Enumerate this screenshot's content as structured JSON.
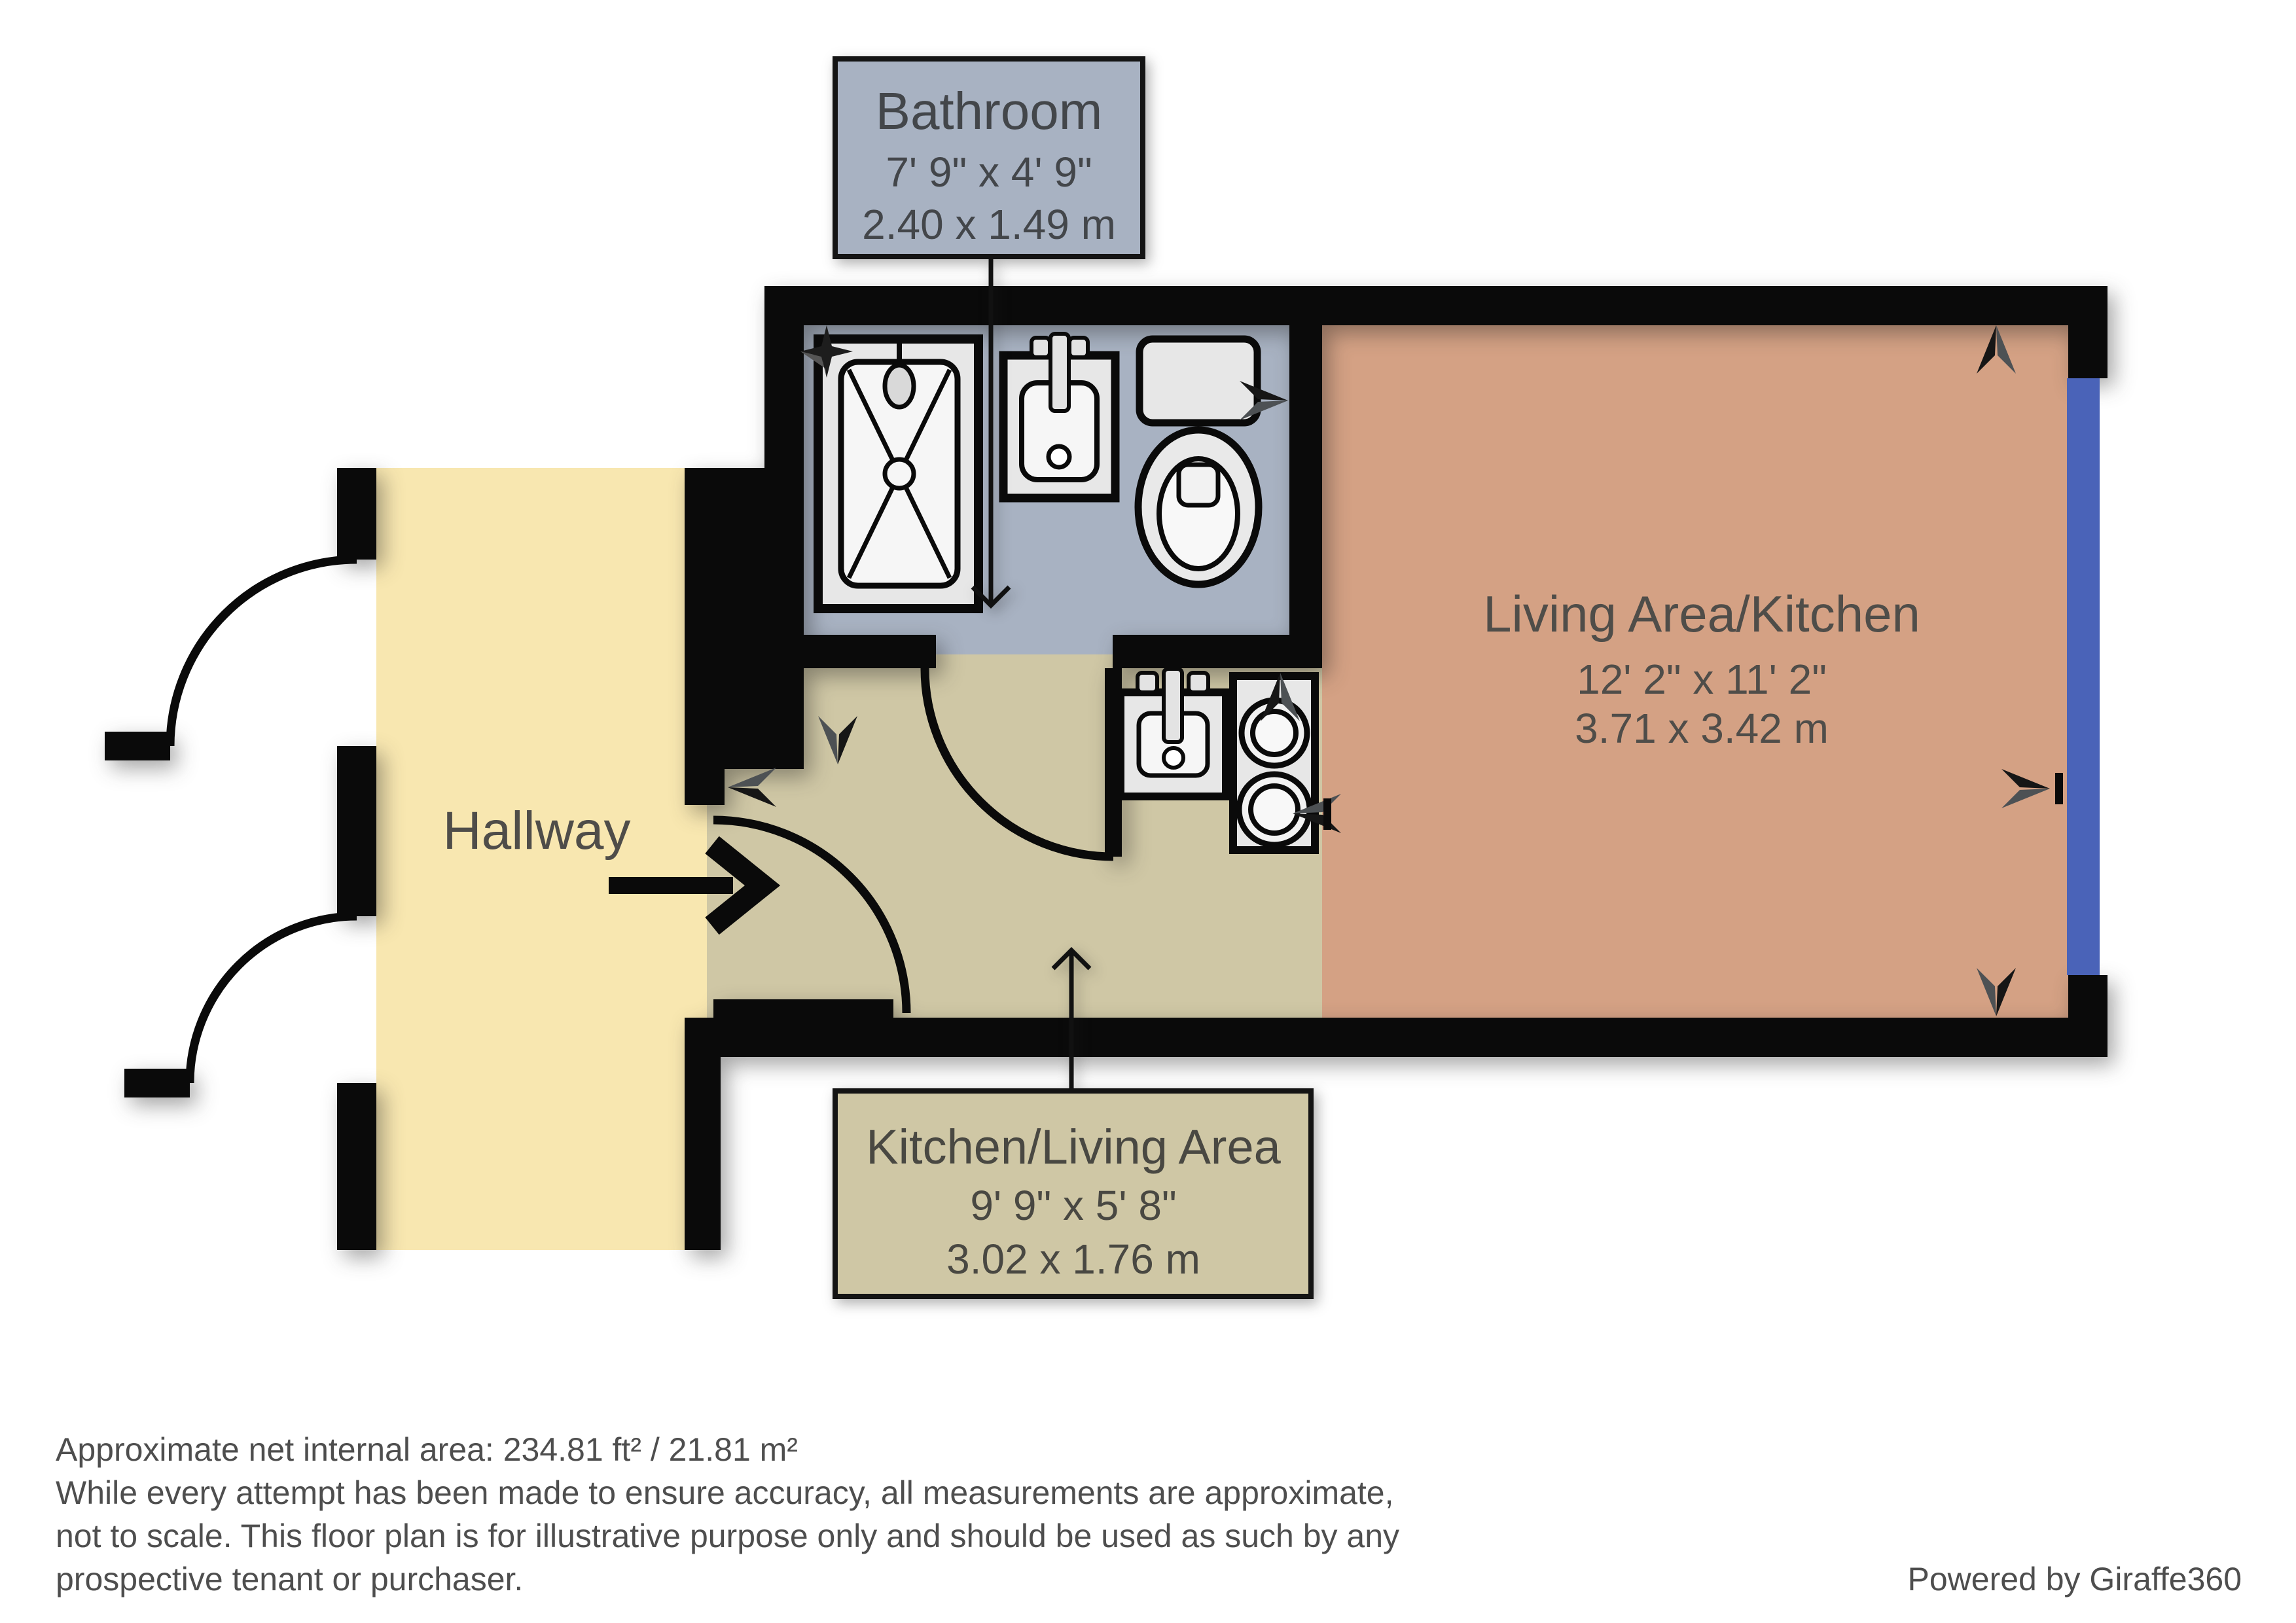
{
  "plan": {
    "rooms": {
      "bathroom": {
        "name": "Bathroom",
        "imperial": "7' 9\" x 4' 9\"",
        "metric": "2.40 x 1.49 m"
      },
      "living": {
        "name": "Living Area/Kitchen",
        "imperial": "12' 2\" x 11' 2\"",
        "metric": "3.71 x 3.42 m"
      },
      "kitchen": {
        "name": "Kitchen/Living Area",
        "imperial": "9' 9\" x 5' 8\"",
        "metric": "3.02 x 1.76 m"
      },
      "hallway": {
        "name": "Hallway"
      }
    },
    "colors": {
      "wall": "#0a0a0a",
      "bathroom_floor": "#a8b2c2",
      "hallway_floor": "#f8e7b0",
      "kitchen_floor": "#cfc7a5",
      "living_floor": "#d4a184",
      "window": "#4a63b8",
      "fixture_fill": "#e7e7e7",
      "fixture_inner": "#f6f6f6"
    }
  },
  "footer": {
    "area_note": "Approximate net internal area: 234.81 ft² / 21.81 m²",
    "disclaimer_line1": "While every attempt has been made to ensure accuracy, all measurements are approximate,",
    "disclaimer_line2": "not to scale. This floor plan is for illustrative purpose only and should be used as such by any",
    "disclaimer_line3": "prospective tenant or purchaser.",
    "credit": "Powered by Giraffe360"
  }
}
